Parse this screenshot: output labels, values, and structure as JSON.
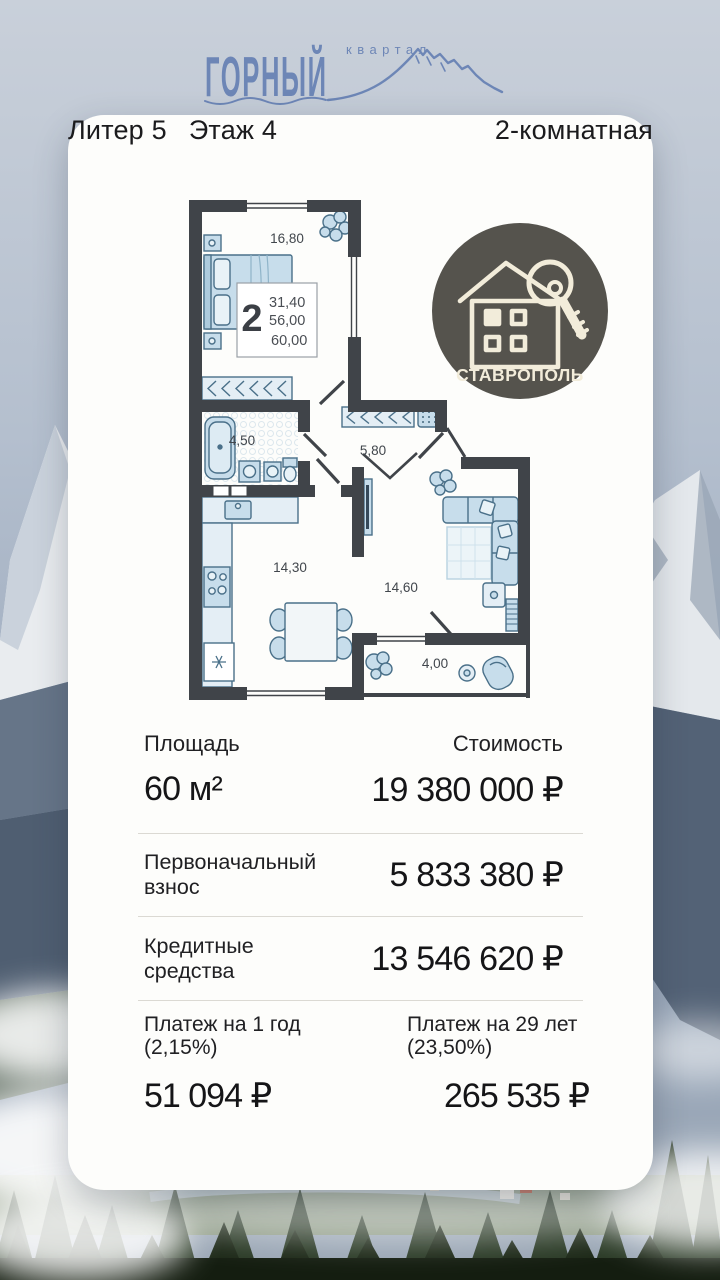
{
  "logo": {
    "brand": "ГОРНЫЙ",
    "sub": "квартал"
  },
  "header": {
    "block": "Литер 5",
    "floor": "Этаж 4",
    "rooms": "2-комнатная"
  },
  "badge": {
    "city": "СТАВРОПОЛЬ"
  },
  "plan": {
    "rooms": [
      {
        "name": "bedroom",
        "area": "16,80"
      },
      {
        "name": "bathroom",
        "area": "4,50"
      },
      {
        "name": "hallway",
        "area": "5,80"
      },
      {
        "name": "kitchen",
        "area": "14,30"
      },
      {
        "name": "living-room",
        "area": "14,60"
      },
      {
        "name": "balcony",
        "area": "4,00"
      }
    ],
    "info_box": {
      "rooms_count": "2",
      "living_area": "31,40",
      "area_wo_balcony": "56,00",
      "total_area": "60,00"
    }
  },
  "details": {
    "area": {
      "label": "Площадь",
      "value": "60 м²"
    },
    "price": {
      "label": "Стоимость",
      "value": "19 380 000 ₽"
    },
    "down_payment": {
      "label": "Первоначальный взнос",
      "value": "5 833 380 ₽"
    },
    "credit": {
      "label": "Кредитные средства",
      "value": "13 546 620 ₽"
    },
    "payment_year1": {
      "label": "Платеж на 1 год",
      "rate": "(2,15%)",
      "value": "51 094 ₽"
    },
    "payment_rest": {
      "label": "Платеж на 29 лет",
      "rate": "(23,50%)",
      "value": "265 535 ₽"
    }
  },
  "colors": {
    "logo_blue": "#6d86b6",
    "badge_bg": "#55534d",
    "badge_cream": "#f2ecda",
    "wall": "#404449",
    "furniture_fill": "#c7ddeb",
    "furniture_stroke": "#4a7089",
    "card_bg": "#fdfdfb",
    "text": "#1c1c1e",
    "divider": "#dbd9d3"
  }
}
